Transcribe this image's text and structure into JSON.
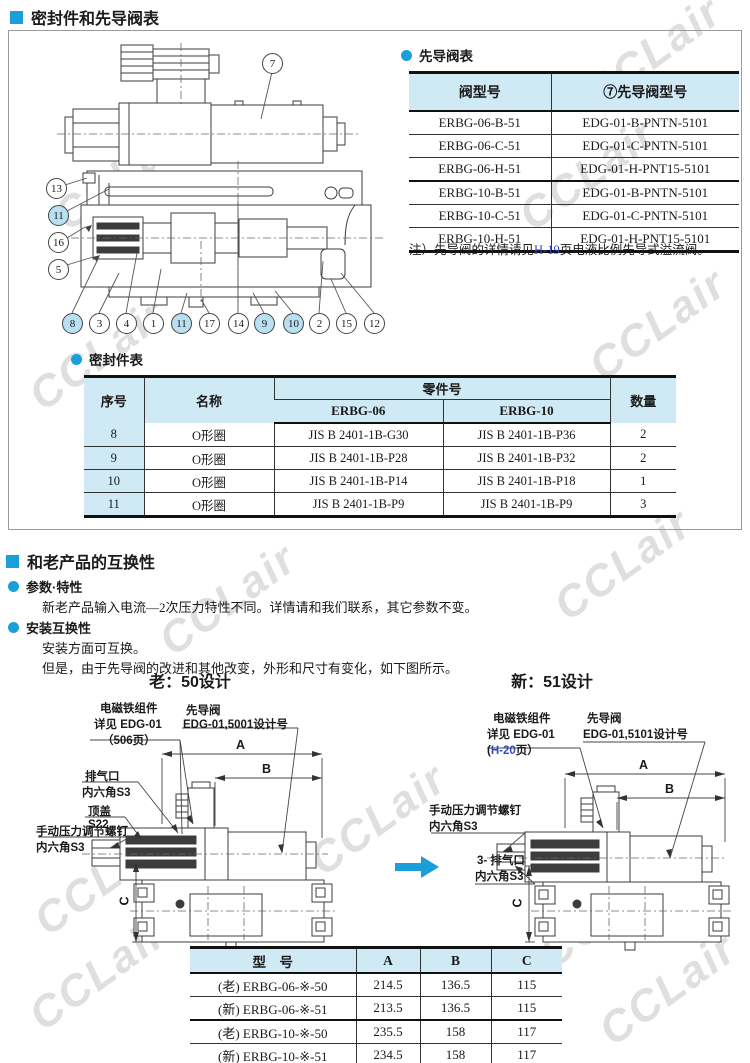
{
  "sections": {
    "top_title": "密封件和先导阀表",
    "compat_title": "和老产品的互换性"
  },
  "watermark": {
    "text": "CCLair"
  },
  "colors": {
    "accent": "#1b9fd8",
    "table_header_bg": "#cfe9f5",
    "callout_highlight_bg": "#b9e0f0",
    "link": "#3948c6"
  },
  "pilot_table": {
    "title": "先导阀表",
    "col1": "阀型号",
    "col2": "⑦先导阀型号",
    "rows": [
      [
        "ERBG-06-B-51",
        "EDG-01-B-PNTN-5101"
      ],
      [
        "ERBG-06-C-51",
        "EDG-01-C-PNTN-5101"
      ],
      [
        "ERBG-06-H-51",
        "EDG-01-H-PNT15-5101"
      ],
      [
        "ERBG-10-B-51",
        "EDG-01-B-PNTN-5101"
      ],
      [
        "ERBG-10-C-51",
        "EDG-01-C-PNTN-5101"
      ],
      [
        "ERBG-10-H-51",
        "EDG-01-H-PNT15-5101"
      ]
    ],
    "note_prefix": "注）先导阀的详情请见",
    "note_link": "H-19",
    "note_suffix": "页电液比例先导式溢流阀。"
  },
  "seal_table": {
    "title": "密封件表",
    "col_no": "序号",
    "col_name": "名称",
    "col_part": "零件号",
    "col_erbg06": "ERBG-06",
    "col_erbg10": "ERBG-10",
    "col_qty": "数量",
    "rows": [
      [
        "8",
        "O形圈",
        "JIS B 2401-1B-G30",
        "JIS B 2401-1B-P36",
        "2"
      ],
      [
        "9",
        "O形圈",
        "JIS B 2401-1B-P28",
        "JIS B 2401-1B-P32",
        "2"
      ],
      [
        "10",
        "O形圈",
        "JIS B 2401-1B-P14",
        "JIS B 2401-1B-P18",
        "1"
      ],
      [
        "11",
        "O形圈",
        "JIS B 2401-1B-P9",
        "JIS B 2401-1B-P9",
        "3"
      ]
    ]
  },
  "compat": {
    "b1_title": "参数·特性",
    "b1_text": "新老产品输入电流—2次压力特性不同。详情请和我们联系，其它参数不变。",
    "b2_title": "安装互换性",
    "b2_text1": "安装方面可互换。",
    "b2_text2": "但是，由于先导阀的改进和其他改变，外形和尺寸有变化，如下图所示。"
  },
  "old_design": {
    "title": "老：50设计",
    "solenoid_l1": "电磁铁组件",
    "solenoid_l2": "详见 EDG-01",
    "solenoid_l3": "（506页）",
    "pilot_l1": "先导阀",
    "pilot_l2": "EDG-01,5001设计号",
    "exhaust_l1": "排气口",
    "exhaust_l2": "内六角S3",
    "cap_l1": "顶盖",
    "cap_l2": "S22",
    "screw_l1": "手动压力调节螺钉",
    "screw_l2": "内六角S3",
    "dim_a": "A",
    "dim_b": "B",
    "dim_c": "C"
  },
  "new_design": {
    "title": "新：51设计",
    "solenoid_l1": "电磁铁组件",
    "solenoid_l2": "详见 EDG-01",
    "solenoid_l3_pre": "(",
    "solenoid_l3_link": "H-20",
    "solenoid_l3_suf": "页）",
    "pilot_l1": "先导阀",
    "pilot_l2": "EDG-01,5101设计号",
    "screw_l1": "手动压力调节螺钉",
    "screw_l2": "内六角S3",
    "exhaust_l1": "3- 排气口",
    "exhaust_l2": "内六角S3",
    "dim_a": "A",
    "dim_b": "B",
    "dim_c": "C"
  },
  "dim_table": {
    "col_model": "型　号",
    "col_a": "A",
    "col_b": "B",
    "col_c": "C",
    "rows": [
      [
        "(老) ERBG-06-※-50",
        "214.5",
        "136.5",
        "115"
      ],
      [
        "(新) ERBG-06-※-51",
        "213.5",
        "136.5",
        "115"
      ],
      [
        "(老) ERBG-10-※-50",
        "235.5",
        "158",
        "117"
      ],
      [
        "(新) ERBG-10-※-51",
        "234.5",
        "158",
        "117"
      ]
    ]
  },
  "callouts": {
    "c7": "7",
    "c13": "13",
    "c11a": "11",
    "c16": "16",
    "c5": "5",
    "c8": "8",
    "c3": "3",
    "c4": "4",
    "c1": "1",
    "c11b": "11",
    "c17": "17",
    "c14": "14",
    "c9": "9",
    "c10": "10",
    "c2": "2",
    "c15": "15",
    "c12": "12"
  }
}
